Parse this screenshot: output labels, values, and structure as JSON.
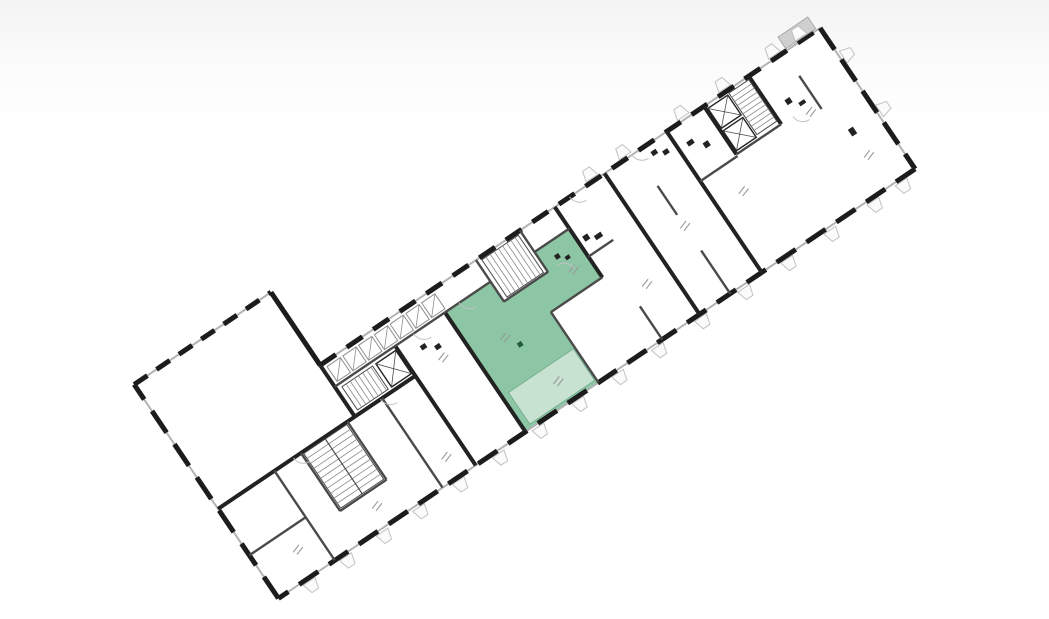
{
  "canvas": {
    "width": 1049,
    "height": 619,
    "background_top": "#f3f3f3",
    "background": "#ffffff"
  },
  "floorplan": {
    "transform": {
      "tx": 190,
      "ty": 453,
      "rotate": -34
    },
    "colors": {
      "wall": "#1c1c1c",
      "thick": "#222222",
      "medium": "#4a4a4a",
      "stair": "#8a8a8a",
      "glass": "#b3b3b3",
      "light": "#c2c2c2",
      "label": "#9a9a9a",
      "hatch": "#8f8f8f",
      "gray_slab": "#cfcfcf",
      "green": "#8cc6a5",
      "green_light": "#c8e2d1",
      "green_stroke": "#357a55",
      "green_dark": "#1f5c38",
      "room_fill": "#ffffff"
    },
    "outline_points": "-8,-88 157,-88 157,0 760,0 760,170 -8,170",
    "edges": [
      {
        "x1": -8,
        "y1": -88,
        "x2": 157,
        "y2": -88,
        "dash": "16 11"
      },
      {
        "x1": 157,
        "y1": -88,
        "x2": 157,
        "y2": 0,
        "dash": null
      },
      {
        "x1": 157,
        "y1": 0,
        "x2": 760,
        "y2": 0,
        "dash": "19 13"
      },
      {
        "x1": 760,
        "y1": 0,
        "x2": 760,
        "y2": 170,
        "dash": "26 12"
      },
      {
        "x1": 760,
        "y1": 170,
        "x2": -8,
        "y2": 170,
        "dash": "23 13"
      },
      {
        "x1": -8,
        "y1": 170,
        "x2": -8,
        "y2": -88,
        "dash": "26 14"
      }
    ],
    "walls_thick": [
      [
        -8,
        62,
        230,
        62
      ],
      [
        157,
        0,
        157,
        62
      ],
      [
        230,
        26,
        230,
        170
      ],
      [
        290,
        26,
        290,
        170
      ],
      [
        440,
        0,
        440,
        85
      ],
      [
        500,
        0,
        500,
        170
      ],
      [
        575,
        0,
        575,
        170
      ],
      [
        620,
        0,
        620,
        58
      ],
      [
        674,
        0,
        674,
        58
      ]
    ],
    "walls_medium": [
      [
        157,
        26,
        345,
        26
      ],
      [
        398,
        26,
        440,
        26
      ],
      [
        345,
        0,
        345,
        50
      ],
      [
        398,
        0,
        398,
        50
      ],
      [
        345,
        50,
        398,
        50
      ],
      [
        378,
        85,
        378,
        170
      ],
      [
        378,
        85,
        440,
        85
      ],
      [
        60,
        62,
        60,
        170
      ],
      [
        -8,
        118,
        60,
        118
      ],
      [
        92,
        62,
        92,
        132
      ],
      [
        148,
        62,
        148,
        132
      ],
      [
        92,
        132,
        148,
        132
      ],
      [
        190,
        62,
        190,
        170
      ],
      [
        620,
        58,
        674,
        58
      ],
      [
        537,
        40,
        537,
        75
      ],
      [
        537,
        118,
        537,
        170
      ],
      [
        440,
        60,
        470,
        60
      ],
      [
        575,
        60,
        620,
        60
      ],
      [
        716,
        28,
        716,
        68
      ],
      [
        455,
        130,
        455,
        170
      ]
    ],
    "highlight": {
      "main_points": "290,26 345,26 345,50 398,50 398,26 440,26 440,85 378,85 378,170 290,170",
      "loggia_points": "298,128 376,128 376,166 298,166",
      "dot": {
        "x": 332,
        "y": 92,
        "w": 5,
        "h": 5
      }
    },
    "stairs": [
      {
        "x": 350,
        "y": 3,
        "w": 44,
        "h": 45,
        "dir": "v",
        "step": 5,
        "rail": false
      },
      {
        "x": 648,
        "y": 3,
        "w": 24,
        "h": 50,
        "dir": "h",
        "step": 5,
        "rail": false
      },
      {
        "x": 94,
        "y": 64,
        "w": 52,
        "h": 66,
        "dir": "h",
        "step": 6,
        "rail": true
      },
      {
        "x": 163,
        "y": 30,
        "w": 37,
        "h": 28,
        "dir": "v",
        "step": 5,
        "rail": false
      }
    ],
    "elevators": [
      {
        "x": 204,
        "y": 30,
        "w": 24,
        "h": 28
      },
      {
        "x": 622,
        "y": 4,
        "w": 24,
        "h": 24
      },
      {
        "x": 622,
        "y": 31,
        "w": 24,
        "h": 24
      }
    ],
    "hatch_boxes": {
      "xs": [
        162,
        181,
        200,
        219,
        238,
        257,
        276
      ],
      "y": 5,
      "w": 16,
      "h": 18
    },
    "gray_slabs": [
      {
        "x": 720,
        "y": -16,
        "w": 36,
        "h": 14
      }
    ],
    "fixtures": [
      [
        446,
        40,
        6,
        6
      ],
      [
        456,
        46,
        8,
        5
      ],
      [
        585,
        20,
        7,
        5
      ],
      [
        598,
        30,
        6,
        6
      ],
      [
        690,
        40,
        6,
        6
      ],
      [
        700,
        50,
        7,
        4
      ],
      [
        726,
        100,
        6,
        8
      ],
      [
        250,
        40,
        6,
        5
      ],
      [
        262,
        48,
        6,
        5
      ],
      [
        412,
        40,
        5,
        5
      ],
      [
        420,
        47,
        5,
        4
      ],
      [
        550,
        8,
        6,
        5
      ],
      [
        560,
        14,
        6,
        5
      ]
    ],
    "label_marks": [
      [
        30,
        140
      ],
      [
        120,
        148
      ],
      [
        205,
        146
      ],
      [
        258,
        62
      ],
      [
        320,
        80
      ],
      [
        340,
        146
      ],
      [
        415,
        62
      ],
      [
        468,
        115
      ],
      [
        532,
        88
      ],
      [
        600,
        92
      ],
      [
        700,
        64
      ],
      [
        724,
        132
      ]
    ],
    "door_arcs": [
      "M307,26 A13,13 0 0 0 320,39",
      "M252,26 A13,13 0 0 0 265,39",
      "M188,62 A12,12 0 0 0 200,74",
      "M83,62 A12,12 0 0 0 95,74",
      "M410,50 A12,12 0 0 1 422,62",
      "M533,0 A12,12 0 0 0 545,12",
      "M688,58 A12,12 0 0 0 700,70",
      "M458,0 A12,12 0 0 0 470,12"
    ],
    "window_wings": [
      {
        "side": "bottom",
        "pos": 20
      },
      {
        "side": "bottom",
        "pos": 64
      },
      {
        "side": "bottom",
        "pos": 108
      },
      {
        "side": "bottom",
        "pos": 152
      },
      {
        "side": "bottom",
        "pos": 200
      },
      {
        "side": "bottom",
        "pos": 248
      },
      {
        "side": "bottom",
        "pos": 296
      },
      {
        "side": "bottom",
        "pos": 344
      },
      {
        "side": "bottom",
        "pos": 392
      },
      {
        "side": "bottom",
        "pos": 440
      },
      {
        "side": "bottom",
        "pos": 492
      },
      {
        "side": "bottom",
        "pos": 544
      },
      {
        "side": "bottom",
        "pos": 596
      },
      {
        "side": "bottom",
        "pos": 648
      },
      {
        "side": "bottom",
        "pos": 700
      },
      {
        "side": "bottom",
        "pos": 734
      },
      {
        "side": "top",
        "pos": 480
      },
      {
        "side": "top",
        "pos": 520
      },
      {
        "side": "top",
        "pos": 590
      },
      {
        "side": "top",
        "pos": 640
      },
      {
        "side": "top",
        "pos": 700
      },
      {
        "side": "top",
        "pos": 732
      },
      {
        "side": "right",
        "pos": 30
      },
      {
        "side": "right",
        "pos": 95
      }
    ]
  }
}
